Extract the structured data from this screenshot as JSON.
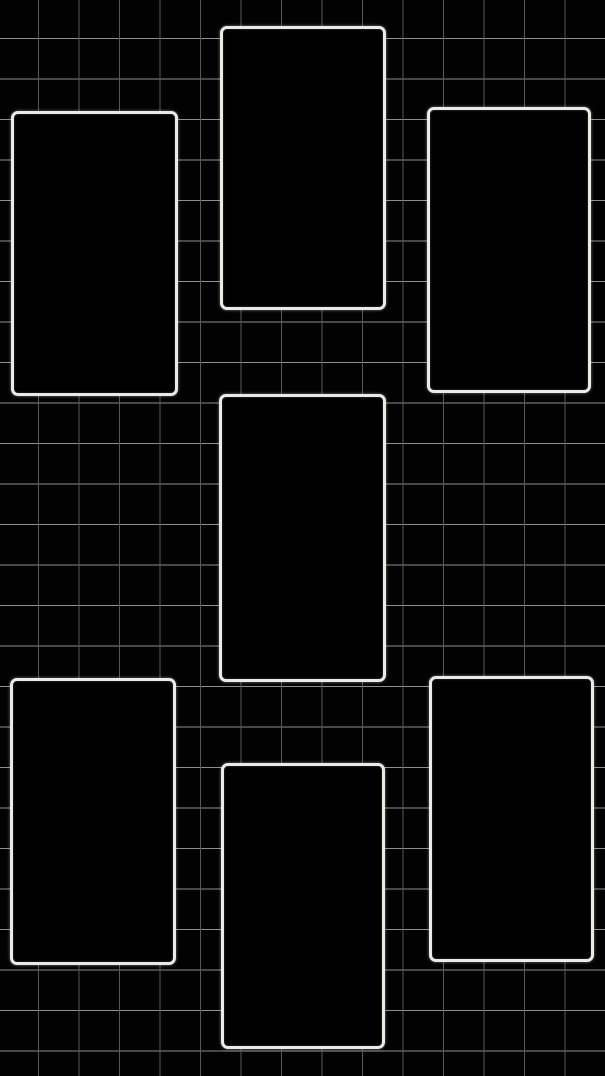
{
  "canvas": {
    "width": 605,
    "height": 1076,
    "background_color": "#020202"
  },
  "grid": {
    "cell_size_px": 40.5,
    "offset_x_px": 38,
    "offset_y_px": 38,
    "vertical_line_color": "#585858",
    "horizontal_line_color": "#8f8f8f",
    "line_width_px": 1
  },
  "frame_style": {
    "fill": "#000000",
    "border_color": "#eceae4",
    "border_width_px": 3.5,
    "corner_radius_px": 7
  },
  "frames": [
    {
      "id": "photo-frame-top-left",
      "x": 11,
      "y": 111,
      "w": 167,
      "h": 285
    },
    {
      "id": "photo-frame-top-center",
      "x": 220,
      "y": 26,
      "w": 166,
      "h": 284
    },
    {
      "id": "photo-frame-top-right",
      "x": 427,
      "y": 107,
      "w": 164,
      "h": 286
    },
    {
      "id": "photo-frame-middle-center",
      "x": 219,
      "y": 394,
      "w": 167,
      "h": 288
    },
    {
      "id": "photo-frame-bottom-left",
      "x": 10,
      "y": 678,
      "w": 166,
      "h": 287
    },
    {
      "id": "photo-frame-bottom-center",
      "x": 221,
      "y": 763,
      "w": 164,
      "h": 286
    },
    {
      "id": "photo-frame-bottom-right",
      "x": 429,
      "y": 676,
      "w": 165,
      "h": 286
    }
  ]
}
